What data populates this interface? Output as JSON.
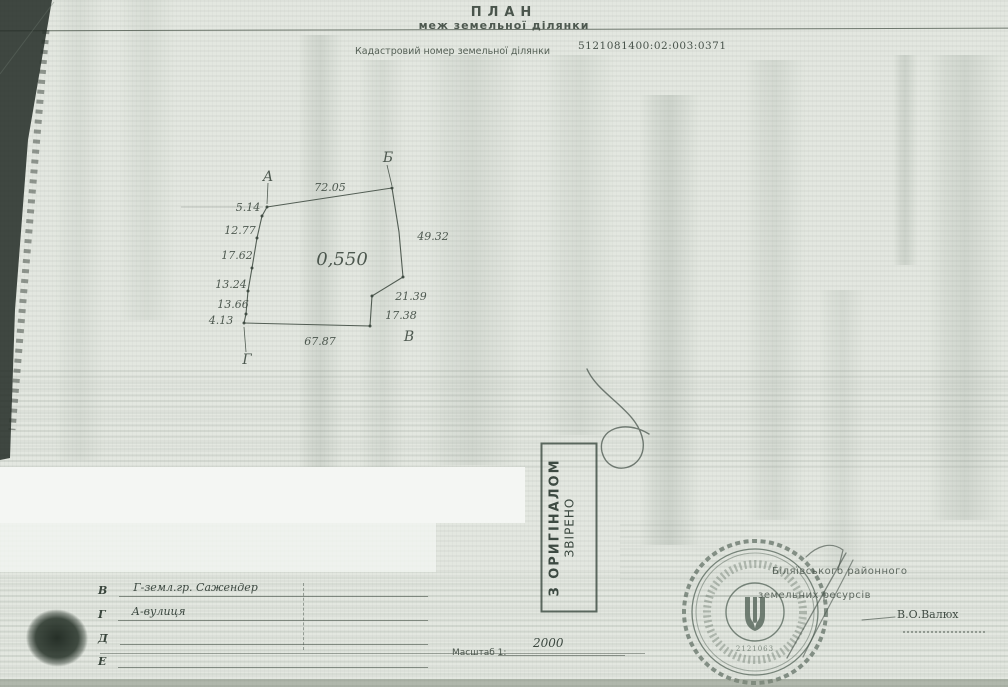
{
  "document": {
    "title": "ПЛАН",
    "subtitle": "меж земельної ділянки",
    "cadastral_label": "Кадастровий номер земельної ділянки",
    "cadastral_number": "5121081400:02:003:0371"
  },
  "colors": {
    "paper": "#e3e7e0",
    "ink": "#39453c",
    "stamp_ink": "#3d4a42",
    "seal_ink": "#4e5e52",
    "white_band": "#f4f6f3"
  },
  "plan": {
    "area_label": "0,550",
    "vertex_names": [
      "А",
      "Б",
      "В",
      "Г"
    ],
    "side_lengths": {
      "top_AB": 72.05,
      "left_A_to_G": [
        5.14,
        12.77,
        17.62,
        13.24,
        13.66,
        4.13
      ],
      "right_B_to_V": [
        49.32,
        21.39,
        17.38
      ],
      "bottom_GV": 67.87
    },
    "polylines": [
      {
        "pts": "267,207 262,216 257,238 252,268 248,291 246,314 244,323",
        "w": 1.1
      },
      {
        "pts": "267,207 392,188",
        "w": 1
      },
      {
        "pts": "392,188 399,232 403,277",
        "w": 1.1
      },
      {
        "pts": "403,277 372,296 370,326",
        "w": 1.1
      },
      {
        "pts": "244,323 370,326",
        "w": 1.1
      },
      {
        "pts": "268,183 267,204",
        "w": 0.8
      },
      {
        "pts": "387,165 392,186",
        "w": 0.8
      },
      {
        "pts": "246,352 244,327",
        "w": 0.8
      },
      {
        "pts": "181,207 263,207",
        "w": 0.7,
        "o": 0.3
      }
    ],
    "points": [
      [
        267,
        207
      ],
      [
        262,
        216
      ],
      [
        257,
        238
      ],
      [
        252,
        268
      ],
      [
        248,
        291
      ],
      [
        246,
        314
      ],
      [
        244,
        323
      ],
      [
        392,
        188
      ],
      [
        403,
        277
      ],
      [
        372,
        296
      ],
      [
        370,
        326
      ]
    ],
    "labels": [
      {
        "t": "А",
        "x": 268,
        "y": 181,
        "s": 14,
        "cls": "pt"
      },
      {
        "t": "Б",
        "x": 388,
        "y": 162,
        "s": 14,
        "cls": "pt"
      },
      {
        "t": "В",
        "x": 409,
        "y": 341,
        "s": 14,
        "cls": "pt"
      },
      {
        "t": "Г",
        "x": 247,
        "y": 364,
        "s": 14,
        "cls": "pt"
      },
      {
        "t": "72.05",
        "x": 330,
        "y": 191,
        "s": 11
      },
      {
        "t": "5.14",
        "x": 248,
        "y": 211,
        "s": 11
      },
      {
        "t": "12.77",
        "x": 240,
        "y": 234,
        "s": 11
      },
      {
        "t": "17.62",
        "x": 237,
        "y": 259,
        "s": 11
      },
      {
        "t": "13.24",
        "x": 231,
        "y": 288,
        "s": 11
      },
      {
        "t": "13.66",
        "x": 233,
        "y": 308,
        "s": 11
      },
      {
        "t": "4.13",
        "x": 221,
        "y": 324,
        "s": 11
      },
      {
        "t": "49.32",
        "x": 433,
        "y": 240,
        "s": 11
      },
      {
        "t": "21.39",
        "x": 411,
        "y": 300,
        "s": 11
      },
      {
        "t": "17.38",
        "x": 401,
        "y": 319,
        "s": 11
      },
      {
        "t": "67.87",
        "x": 320,
        "y": 345,
        "s": 11
      },
      {
        "t": "0,550",
        "x": 342,
        "y": 265,
        "s": 18,
        "cls": "area"
      }
    ]
  },
  "stamp": {
    "line1": "З ОРИГІНАЛОМ",
    "line2": "ЗВІРЕНО"
  },
  "seal": {
    "number": "2121063"
  },
  "legend": {
    "rows": [
      {
        "letter": "В",
        "text": "Г-земл.гр. Сажендер"
      },
      {
        "letter": "Г",
        "text": "А-вулиця"
      },
      {
        "letter": "Д",
        "text": ""
      },
      {
        "letter": "Е",
        "text": ""
      }
    ]
  },
  "scale": {
    "label": "Масштаб 1:",
    "value": "2000"
  },
  "officials": {
    "line1": "Біляївського районного",
    "line2": "земельних ресурсів",
    "signature": "В.О.Валюх"
  },
  "handwriting": {
    "paths": [
      {
        "d": "M587,369 C599,396 638,410 643,441 C647,470 609,479 602,452 C597,429 625,419 649,434",
        "w": 1.4,
        "o": 0.75
      },
      {
        "d": "M846,553 L787,658",
        "w": 1.3,
        "o": 0.65
      },
      {
        "d": "M853,560 C834,598 816,630 803,657",
        "w": 1.2,
        "o": 0.6
      },
      {
        "d": "M806,557 C817,546 831,541 843,550 L838,570",
        "w": 1.2,
        "o": 0.65
      },
      {
        "d": "M862,620 L895,617",
        "w": 1.0,
        "o": 0.7
      }
    ]
  }
}
